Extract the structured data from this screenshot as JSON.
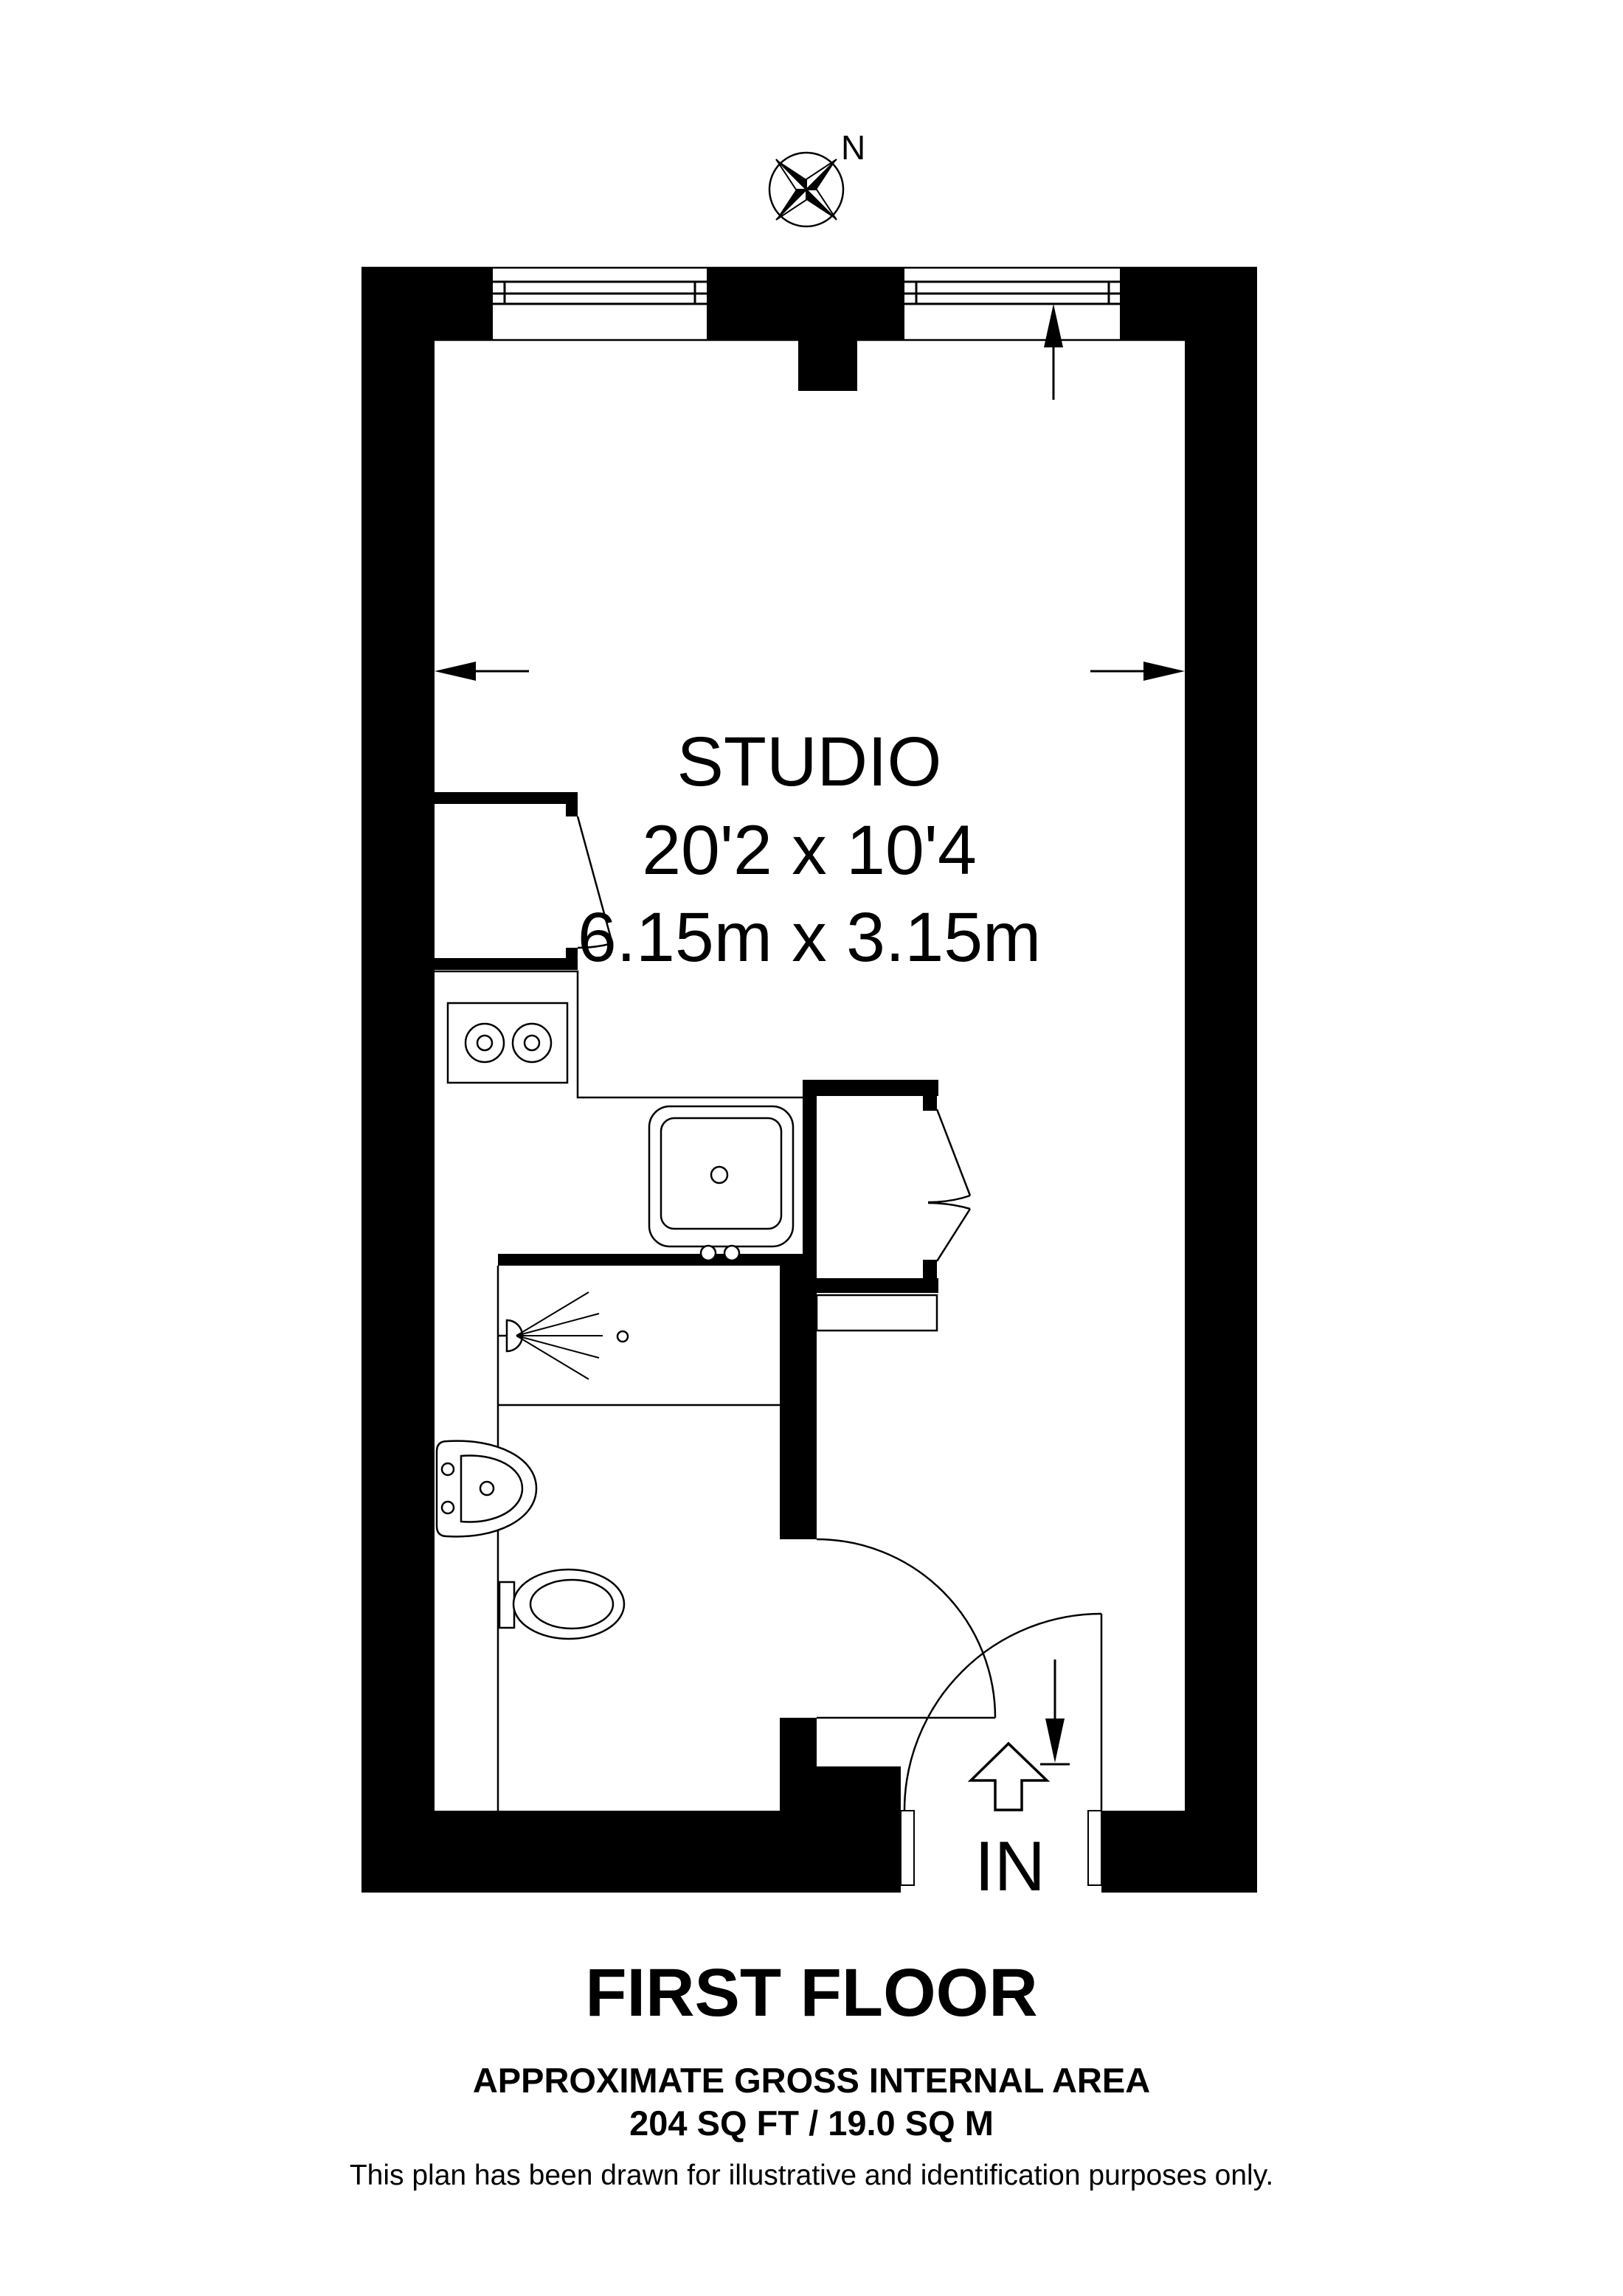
{
  "compass": {
    "north_label": "N"
  },
  "room": {
    "name": "STUDIO",
    "dims_imperial": "20'2 x 10'4",
    "dims_metric": "6.15m x 3.15m"
  },
  "entrance": {
    "label": "IN"
  },
  "footer": {
    "floor_title": "FIRST FLOOR",
    "area_title": "APPROXIMATE GROSS INTERNAL AREA",
    "area_value": "204 SQ FT / 19.0 SQ M",
    "disclaimer": "This plan has been drawn for illustrative and identification purposes only."
  },
  "colors": {
    "wall": "#000000",
    "line": "#000000",
    "background": "#ffffff"
  }
}
